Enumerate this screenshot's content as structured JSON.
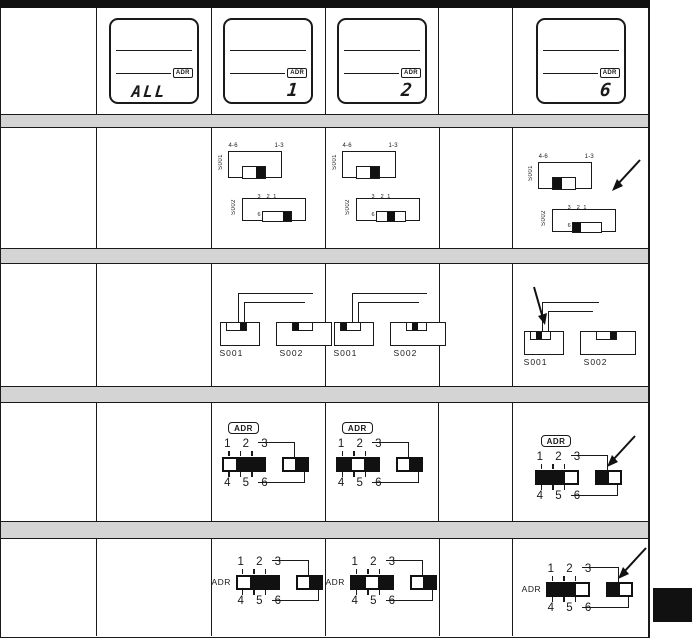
{
  "colors": {
    "ink": "#1a1a1a",
    "gray_bar": "#d4d4d4",
    "tab": "#111111",
    "background": "#ffffff"
  },
  "lcd_displays": [
    {
      "value": "ALL",
      "badge": "ADR"
    },
    {
      "value": "1",
      "badge": "ADR"
    },
    {
      "value": "2",
      "badge": "ADR"
    },
    {
      "value": "6",
      "badge": "ADR"
    }
  ],
  "slide_switch_row": {
    "labels": {
      "s001": "S001",
      "s002": "S002",
      "group_left": "4-6",
      "group_right": "1-3",
      "scale_top": "3  2 1",
      "scale_bottom": "6  5 4"
    },
    "cells": [
      {
        "s001": "right",
        "s002": "right"
      },
      {
        "s001": "right",
        "s002": "center"
      },
      {
        "s001": "left",
        "s002": "left"
      }
    ]
  },
  "notch_switch_row": {
    "labels": {
      "s001": "S001",
      "s002": "S002"
    },
    "cells": [
      {
        "s001": "right",
        "s002": "left"
      },
      {
        "s001": "left",
        "s002": "center"
      },
      {
        "s001": "center",
        "s002": "right"
      }
    ]
  },
  "adr_badge_row": {
    "labels": {
      "adr": "ADR",
      "top_numbers": "1 2 3",
      "bottom_numbers": "4 5 6"
    },
    "cells": [
      {
        "main": "1",
        "aux": "left"
      },
      {
        "main": "2",
        "aux": "left"
      },
      {
        "main": "3",
        "aux": "right"
      }
    ]
  },
  "adr_text_row": {
    "labels": {
      "adr": "ADR",
      "top_numbers": "1 2 3",
      "bottom_numbers": "4 5 6"
    },
    "cells": [
      {
        "main": "1",
        "aux": "left"
      },
      {
        "main": "2",
        "aux": "left"
      },
      {
        "main": "3",
        "aux": "right"
      }
    ]
  }
}
